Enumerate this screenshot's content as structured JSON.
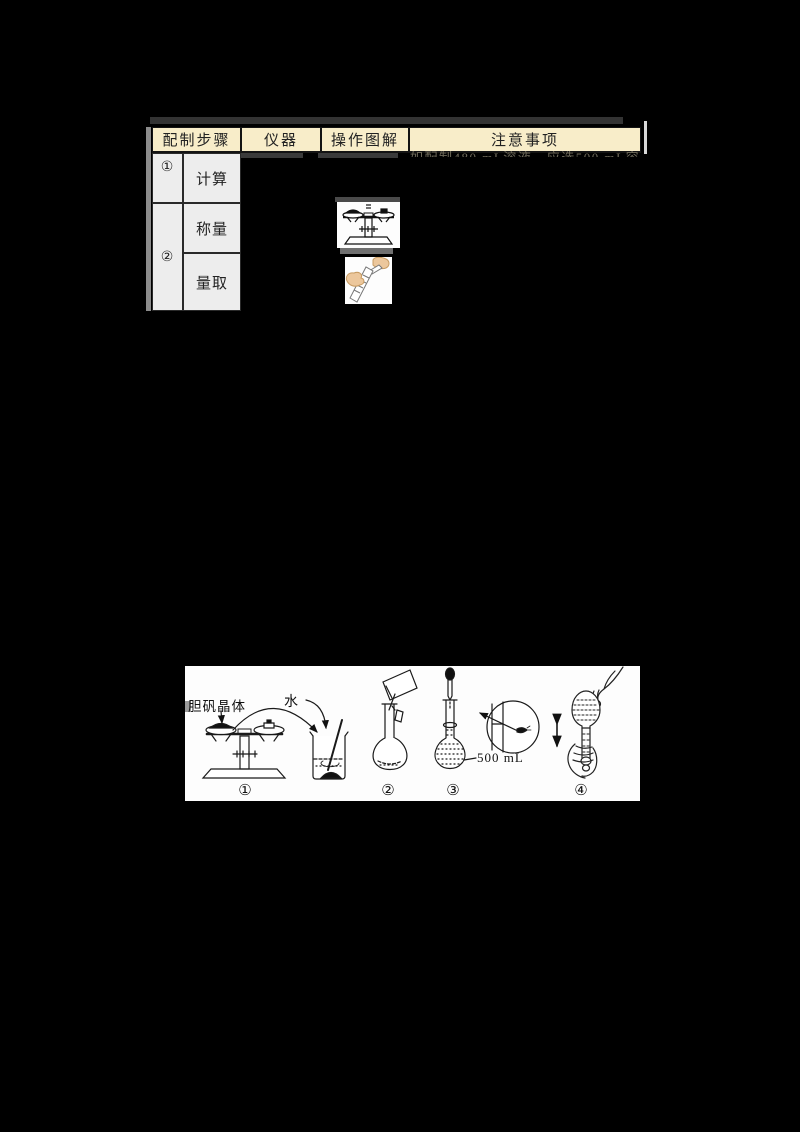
{
  "page": {
    "background": "#000000"
  },
  "table": {
    "headers": {
      "steps": "配制步骤",
      "instrument": "仪器",
      "diagram": "操作图解",
      "notes": "注意事项"
    },
    "step1": {
      "number": "①",
      "label": "计算"
    },
    "step2": {
      "number": "②",
      "label_weigh": "称量",
      "label_measure": "量取"
    },
    "occluded_note": "如配制480 mL溶液，应选500 mL容量瓶",
    "colors": {
      "header_bg": "#f8edc9",
      "cell_bg": "#ededed",
      "border": "#141414"
    },
    "icons": {
      "diagram_weigh": "balance-scale-icon",
      "diagram_measure": "measuring-cylinder-hands-icon"
    }
  },
  "figure": {
    "crystal_label": "胆矾晶体",
    "water_label": "水",
    "volume_label": "500 mL",
    "captions": [
      "①",
      "②",
      "③",
      "④"
    ],
    "background": "#fdfdfd",
    "icons": [
      "balance-scale-figure",
      "beaker-stir-figure",
      "volumetric-flask-pour-figure",
      "volumetric-flask-dropper-figure",
      "eye-level-magnifier-figure",
      "shake-flask-figure"
    ]
  }
}
